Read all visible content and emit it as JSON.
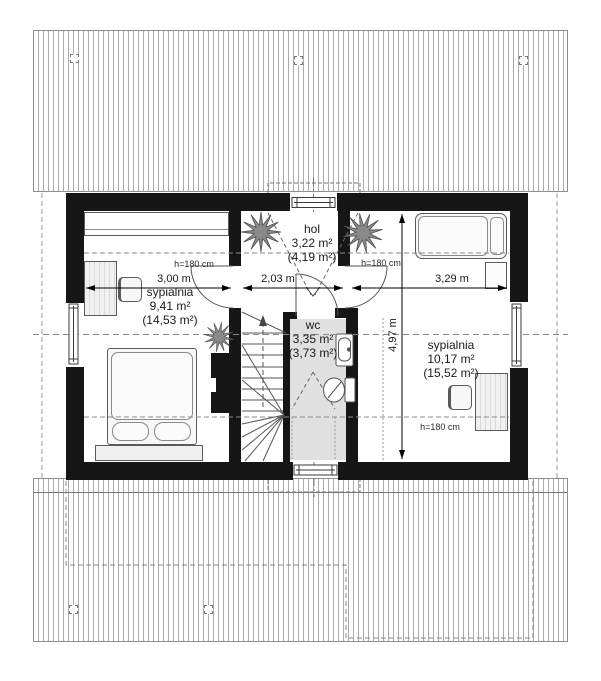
{
  "plan": {
    "rooms": [
      {
        "id": "bedroom-left",
        "name": "sypialnia",
        "area": "9,41 m²",
        "gross_area": "(14,53 m²)"
      },
      {
        "id": "hall",
        "name": "hol",
        "area": "3,22 m²",
        "gross_area": "(4,19 m²)"
      },
      {
        "id": "wc",
        "name": "wc",
        "area": "3,35 m²",
        "gross_area": "(3,73 m²)"
      },
      {
        "id": "bedroom-right",
        "name": "sypialnia",
        "area": "10,17 m²",
        "gross_area": "(15,52 m²)"
      }
    ],
    "dimensions": {
      "bedroom_left_width": "3,00 m",
      "hall_width": "2,03 m",
      "bedroom_right_width": "3,29 m",
      "interior_depth": "4,97 m"
    },
    "height_annotations": {
      "bedroom_left": "h=180 cm",
      "bedroom_right_top": "h=180 cm",
      "bedroom_right_bottom": "h=180 cm"
    },
    "colors": {
      "wall": "#161616",
      "wc_floor": "#e0e0e0",
      "hatch_line": "#ababab"
    }
  }
}
